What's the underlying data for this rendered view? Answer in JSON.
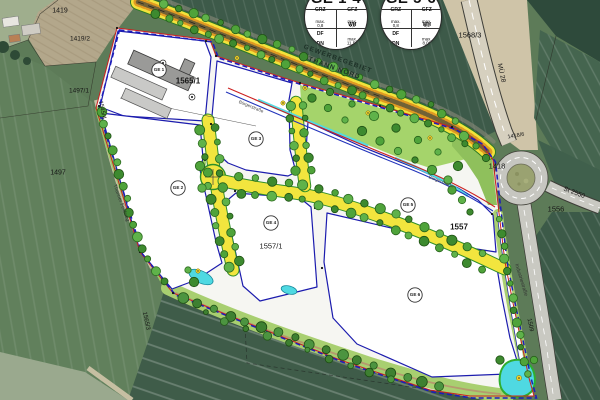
{
  "region_label": {
    "line1": "GEWERBEGEBIET",
    "line2": "THANN NORD"
  },
  "stamps": [
    {
      "title": "GE 1-4",
      "grz_label": "GRZ",
      "grz_value": "max. 0,8",
      "gfz_label": "GFZ",
      "gfz_value": "max. 1,8",
      "roof_line1": "DF",
      "roof_line2": "DN",
      "wh_label": "WH",
      "wh_value": "max. 11,50 m"
    },
    {
      "title": "GE 5-6",
      "grz_label": "GRZ",
      "grz_value": "max. 0,8",
      "gfz_label": "GFZ",
      "gfz_value": "max. 1,2",
      "roof_line1": "DF",
      "roof_line2": "DN",
      "wh_label": "WH",
      "wh_value": "max. 8,00 m"
    }
  ],
  "zones": {
    "ge1": "GE 1",
    "ge2": "GE 2",
    "ge3": "GE 3",
    "ge4": "GE 4",
    "ge5": "GE 5",
    "ge6": "GE 6"
  },
  "parcels": {
    "p1419": "1419",
    "p1419_2": "1419/2",
    "p1497_1": "1497/1",
    "p1497": "1497",
    "p1545_4": "1545/4",
    "p1565_1": "1565/1",
    "p1565_3": "1565/3",
    "p1568_3": "1568/3",
    "p1418": "1418",
    "p1418_6": "1418/6",
    "p1556": "1556",
    "p1557": "1557",
    "p1557_1": "1557/1",
    "p1509": "1509"
  },
  "roads": {
    "mu28": "MÜ 28",
    "st2550": "St 2550",
    "industriestrasse": "Industriestraße",
    "buergerstrasse": "Bürgerstraße",
    "thanner_feldweg": "Thanner Feldweg"
  },
  "colors": {
    "plan_white": "#f6f6f2",
    "parcel_border_blue": "#1c1cae",
    "road_yellow": "#f2e53e",
    "road_edge_green": "#2f8f2a",
    "tree_green": "#4fa33a",
    "landscape_green": "#a5d46b",
    "water_cyan": "#4fd9e2",
    "boundary_red": "#cc2020",
    "boundary_blue": "#2233bb",
    "hatch_orange": "#e09a22",
    "field_dark": "#3f5c49",
    "asphalt": "#c6c6c0"
  }
}
